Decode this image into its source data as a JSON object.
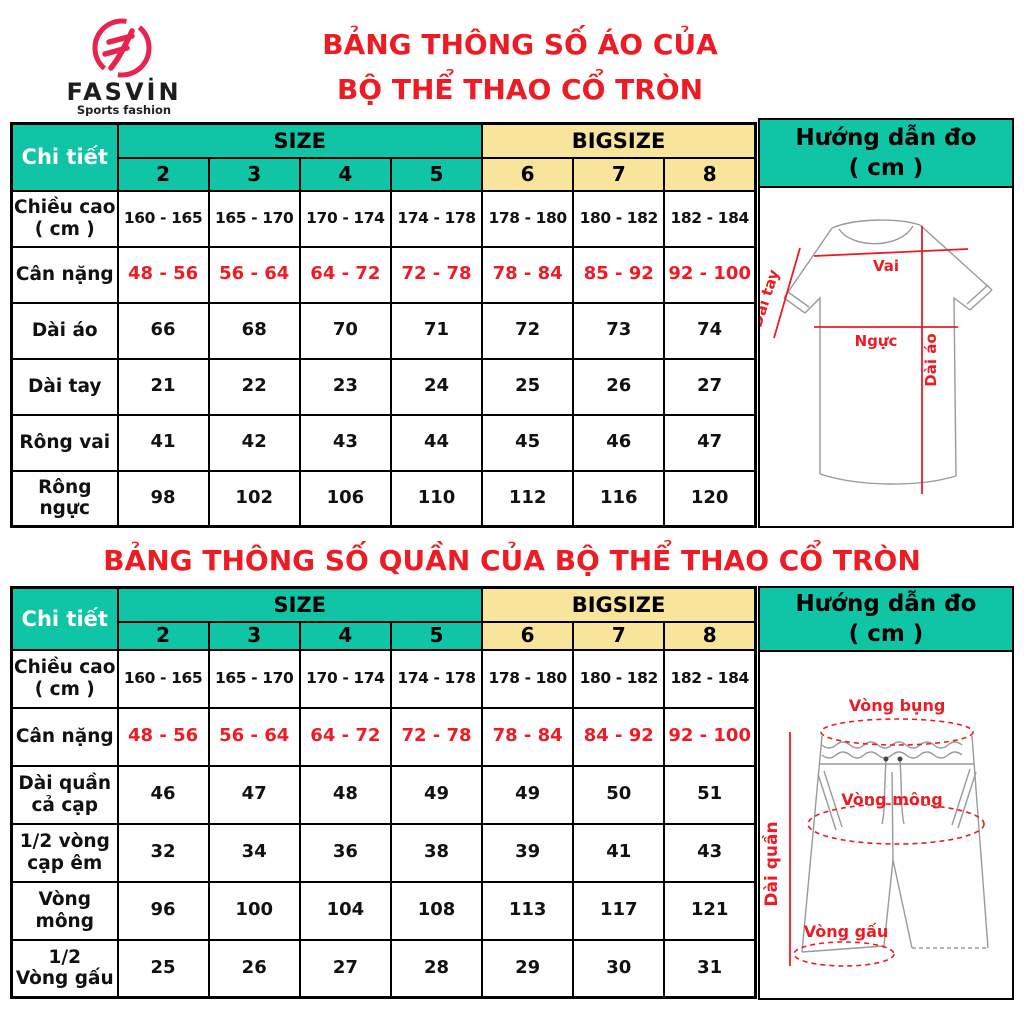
{
  "colors": {
    "teal": "#10C4A6",
    "yellow": "#F8E59B",
    "red": "#ED1C24",
    "logo_red": "#E8234E"
  },
  "brand": {
    "name": "FASVİN",
    "tagline": "Sports fashion"
  },
  "shirt_section": {
    "title_line1": "BẢNG THÔNG SỐ ÁO CỦA",
    "title_line2": "BỘ THỂ THAO CỔ TRÒN",
    "table": {
      "detail_header": "Chi tiết",
      "size_header": "SIZE",
      "bigsize_header": "BIGSIZE",
      "size_numbers": [
        "2",
        "3",
        "4",
        "5",
        "6",
        "7",
        "8"
      ],
      "rows": [
        {
          "label": "Chiều cao\n( cm )",
          "values": [
            "160 - 165",
            "165 - 170",
            "170 - 174",
            "174 - 178",
            "178 - 180",
            "180 - 182",
            "182 - 184"
          ],
          "value_color": "black"
        },
        {
          "label": "Cân nặng",
          "values": [
            "48 - 56",
            "56 - 64",
            "64 - 72",
            "72 - 78",
            "78 - 84",
            "85 - 92",
            "92 - 100"
          ],
          "value_color": "red"
        },
        {
          "label": "Dài áo",
          "values": [
            "66",
            "68",
            "70",
            "71",
            "72",
            "73",
            "74"
          ],
          "value_color": "black"
        },
        {
          "label": "Dài tay",
          "values": [
            "21",
            "22",
            "23",
            "24",
            "25",
            "26",
            "27"
          ],
          "value_color": "black"
        },
        {
          "label": "Rông vai",
          "values": [
            "41",
            "42",
            "43",
            "44",
            "45",
            "46",
            "47"
          ],
          "value_color": "black"
        },
        {
          "label": "Rông ngực",
          "values": [
            "98",
            "102",
            "106",
            "110",
            "112",
            "116",
            "120"
          ],
          "value_color": "black"
        }
      ]
    },
    "guide": {
      "header": "Hướng dẫn đo\n( cm )",
      "labels": {
        "vai": "Vai",
        "dai_tay": "Dài tay",
        "nguc": "Ngực",
        "dai_ao": "Dài áo"
      }
    }
  },
  "pants_section": {
    "title": "BẢNG THÔNG SỐ QUẦN CỦA BỘ THỂ THAO CỔ TRÒN",
    "table": {
      "detail_header": "Chi tiết",
      "size_header": "SIZE",
      "bigsize_header": "BIGSIZE",
      "size_numbers": [
        "2",
        "3",
        "4",
        "5",
        "6",
        "7",
        "8"
      ],
      "rows": [
        {
          "label": "Chiều cao\n( cm )",
          "values": [
            "160 - 165",
            "165 - 170",
            "170 - 174",
            "174 - 178",
            "178 - 180",
            "180 - 182",
            "182 - 184"
          ],
          "value_color": "black"
        },
        {
          "label": "Cân nặng",
          "values": [
            "48 - 56",
            "56 - 64",
            "64 - 72",
            "72 - 78",
            "78 - 84",
            "84 - 92",
            "92 - 100"
          ],
          "value_color": "red"
        },
        {
          "label": "Dài quần\ncả cạp",
          "values": [
            "46",
            "47",
            "48",
            "49",
            "49",
            "50",
            "51"
          ],
          "value_color": "black"
        },
        {
          "label": "1/2 vòng\ncạp êm",
          "values": [
            "32",
            "34",
            "36",
            "38",
            "39",
            "41",
            "43"
          ],
          "value_color": "black"
        },
        {
          "label": "Vòng\nmông",
          "values": [
            "96",
            "100",
            "104",
            "108",
            "113",
            "117",
            "121"
          ],
          "value_color": "black"
        },
        {
          "label": "1/2\nVòng gấu",
          "values": [
            "25",
            "26",
            "27",
            "28",
            "29",
            "30",
            "31"
          ],
          "value_color": "black"
        }
      ]
    },
    "guide": {
      "header": "Hướng dẫn đo\n( cm )",
      "labels": {
        "vong_bung": "Vòng bụng",
        "vong_mong": "Vòng mông",
        "vong_gau": "Vòng gấu",
        "dai_quan": "Dài quần"
      }
    }
  }
}
